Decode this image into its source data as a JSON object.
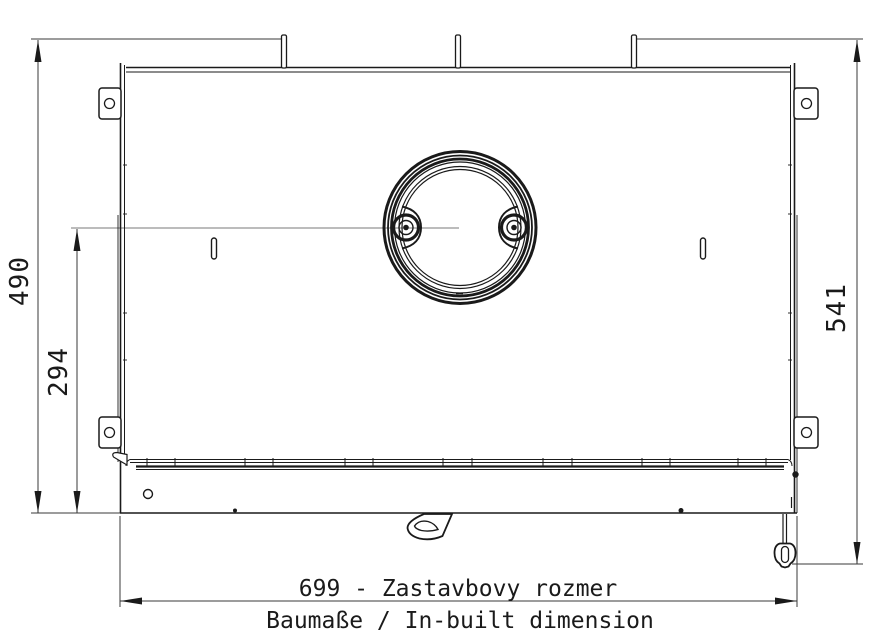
{
  "drawing": {
    "type": "technical-dimension-drawing",
    "subject": "fireplace-insert-top-view",
    "dimension_labels": {
      "height_overall": "490",
      "height_to_flue_center": "294",
      "height_right_overall": "541",
      "width_title": "699 - Zastavbovy rozmer",
      "width_subtitle": "Baumaße / In-built dimension"
    },
    "colors": {
      "line": "#1a1a1a",
      "dimension_line": "#3a3a3a",
      "centerline": "#787878",
      "background": "#ffffff"
    }
  }
}
